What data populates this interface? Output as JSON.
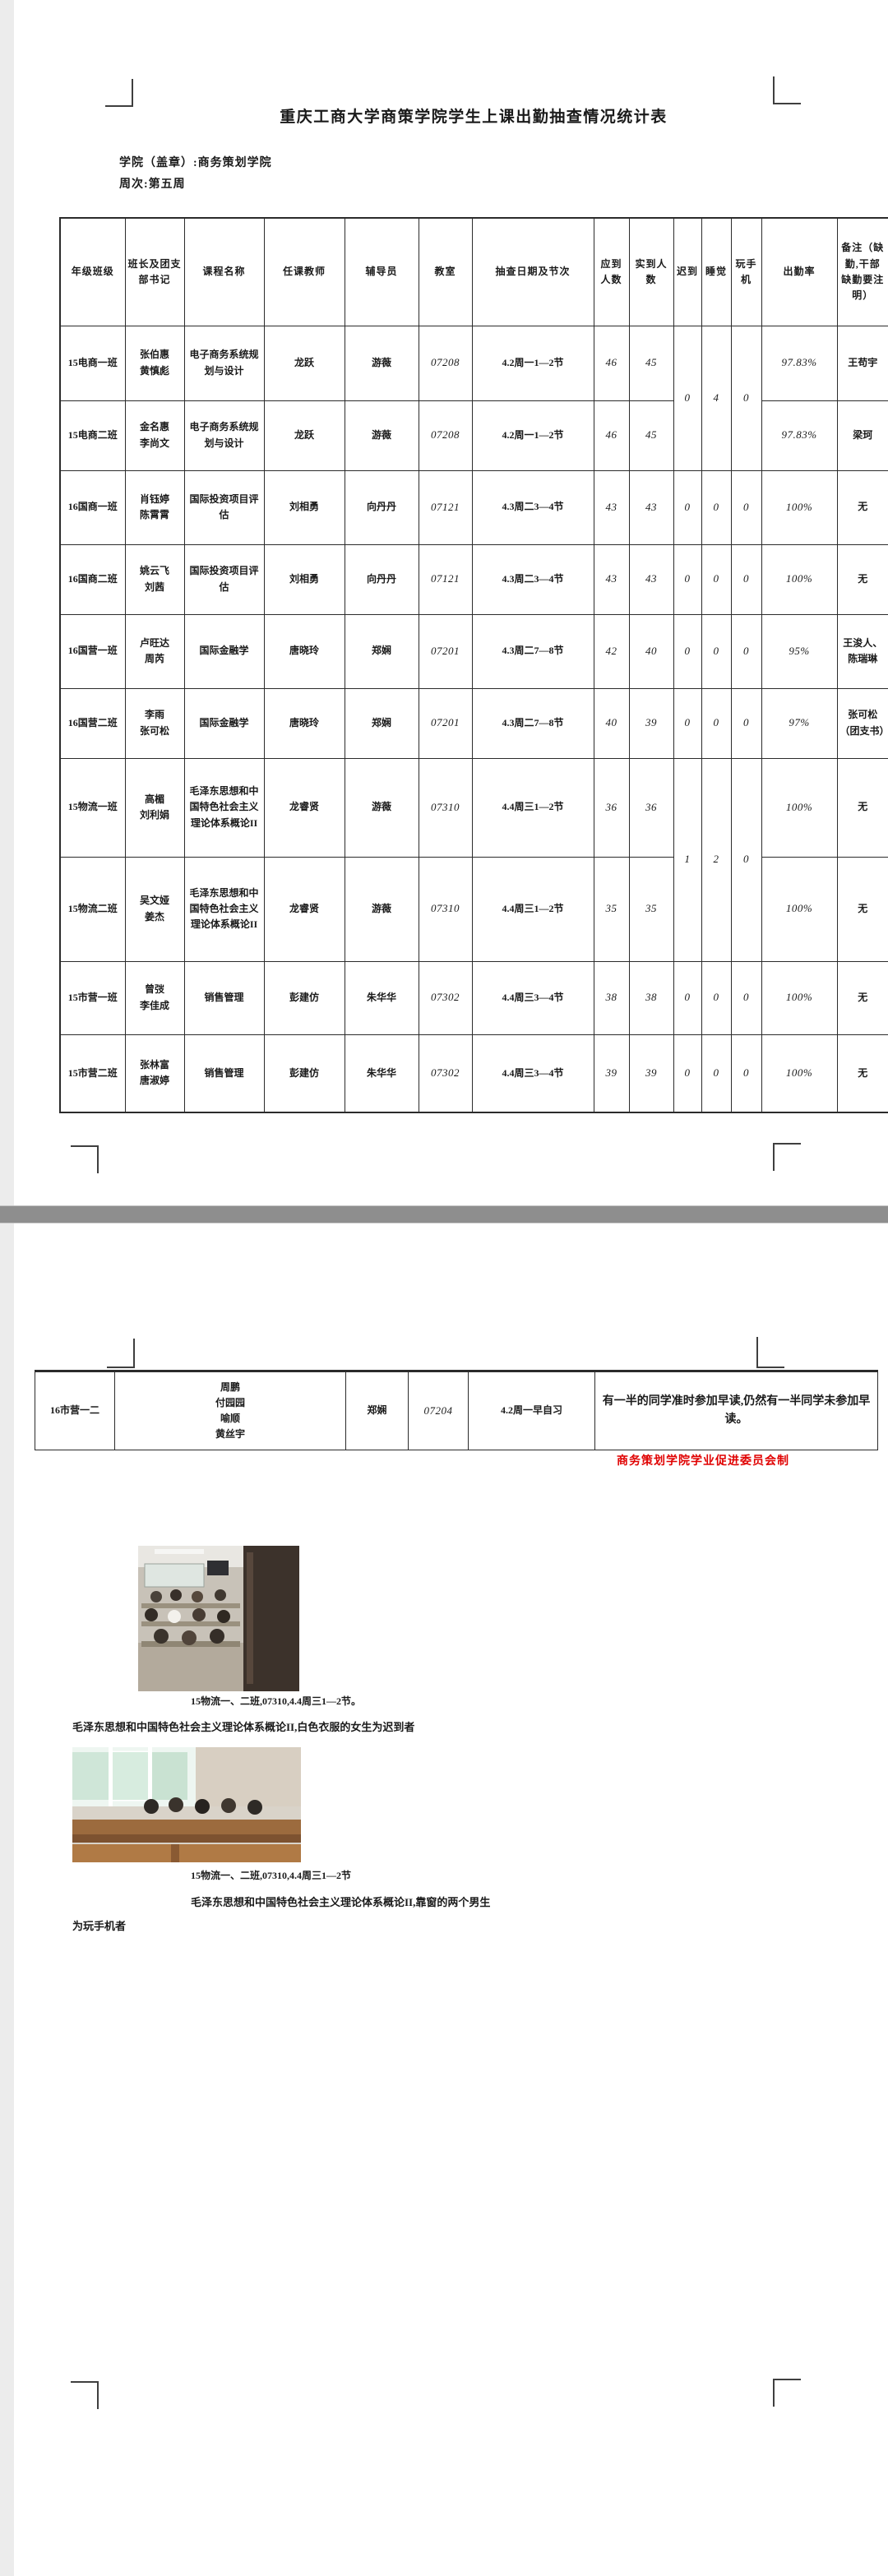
{
  "page1": {
    "title": "重庆工商大学商策学院学生上课出勤抽查情况统计表",
    "college_line": "学院（盖章）:商务策划学院",
    "week_line": "周次:第五周",
    "table": {
      "headers": [
        "年级班级",
        "班长及团支部书记",
        "课程名称",
        "任课教师",
        "辅导员",
        "教室",
        "抽查日期及节次",
        "应到人数",
        "实到人数",
        "迟到",
        "睡觉",
        "玩手机",
        "出勤率",
        "备注（缺勤,干部缺勤要注明）"
      ],
      "rows": [
        [
          "15电商一班",
          "张伯惠\n黄慎彪",
          "电子商务系统规划与设计",
          "龙跃",
          "游薇",
          "07208",
          "4.2周一1—2节",
          "46",
          "45",
          {
            "t": "0",
            "rs": 2
          },
          {
            "t": "4",
            "rs": 2
          },
          {
            "t": "0",
            "rs": 2
          },
          "97.83%",
          "王苟宇"
        ],
        [
          "15电商二班",
          "金名惠\n李尚文",
          "电子商务系统规划与设计",
          "龙跃",
          "游薇",
          "07208",
          "4.2周一1—2节",
          "46",
          "45",
          null,
          null,
          null,
          "97.83%",
          "梁珂"
        ],
        [
          "16国商一班",
          "肖钰婷\n陈霄霄",
          "国际投资项目评估",
          "刘相勇",
          "向丹丹",
          "07121",
          "4.3周二3—4节",
          "43",
          "43",
          "0",
          "0",
          "0",
          "100%",
          "无"
        ],
        [
          "16国商二班",
          "姚云飞\n刘茜",
          "国际投资项目评估",
          "刘相勇",
          "向丹丹",
          "07121",
          "4.3周二3—4节",
          "43",
          "43",
          "0",
          "0",
          "0",
          "100%",
          "无"
        ],
        [
          "16国营一班",
          "卢旺达\n周芮",
          "国际金融学",
          "唐晓玲",
          "郑娴",
          "07201",
          "4.3周二7—8节",
          "42",
          "40",
          "0",
          "0",
          "0",
          "95%",
          "王浚人、陈瑞琳"
        ],
        [
          "16国营二班",
          "李雨\n张可松",
          "国际金融学",
          "唐晓玲",
          "郑娴",
          "07201",
          "4.3周二7—8节",
          "40",
          "39",
          "0",
          "0",
          "0",
          "97%",
          "张可松（团支书）"
        ],
        [
          "15物流一班",
          "高楣\n刘利娟",
          "毛泽东思想和中国特色社会主义理论体系概论II",
          "龙睿贤",
          "游薇",
          "07310",
          "4.4周三1—2节",
          "36",
          "36",
          {
            "t": "1",
            "rs": 2
          },
          {
            "t": "2",
            "rs": 2
          },
          {
            "t": "0",
            "rs": 2
          },
          "100%",
          "无"
        ],
        [
          "15物流二班",
          "吴文娅\n姜杰",
          "毛泽东思想和中国特色社会主义理论体系概论II",
          "龙睿贤",
          "游薇",
          "07310",
          "4.4周三1—2节",
          "35",
          "35",
          null,
          null,
          null,
          "100%",
          "无"
        ],
        [
          "15市营一班",
          "曾弢\n李佳成",
          "销售管理",
          "彭建仿",
          "朱华华",
          "07302",
          "4.4周三3—4节",
          "38",
          "38",
          "0",
          "0",
          "0",
          "100%",
          "无"
        ],
        [
          "15市营二班",
          "张林富\n唐淑婷",
          "销售管理",
          "彭建仿",
          "朱华华",
          "07302",
          "4.4周三3—4节",
          "39",
          "39",
          "0",
          "0",
          "0",
          "100%",
          "无"
        ]
      ]
    }
  },
  "page2": {
    "table": {
      "rows": [
        [
          "16市营一二",
          "周鹏\n付园园\n喻顺\n黄丝宇",
          "郑娴",
          "07204",
          "4.2周一早自习",
          "有一半的同学准时参加早读,仍然有一半同学未参加早读。"
        ]
      ]
    },
    "footer_red": "商务策划学院学业促进委员会制",
    "photo1": {
      "caption_line1": "15物流一、二班,07310,4.4周三1—2节。",
      "caption_line2": "毛泽东思想和中国特色社会主义理论体系概论II,白色衣服的女生为迟到者"
    },
    "photo2": {
      "caption_line1": "15物流一、二班,07310,4.4周三1—2节",
      "caption_line2": "毛泽东思想和中国特色社会主义理论体系概论II,靠窗的两个男生",
      "caption_line3": "为玩手机者"
    }
  },
  "colors": {
    "accent_red": "#e00000",
    "page_gap_gray": "#8e8e8e"
  }
}
